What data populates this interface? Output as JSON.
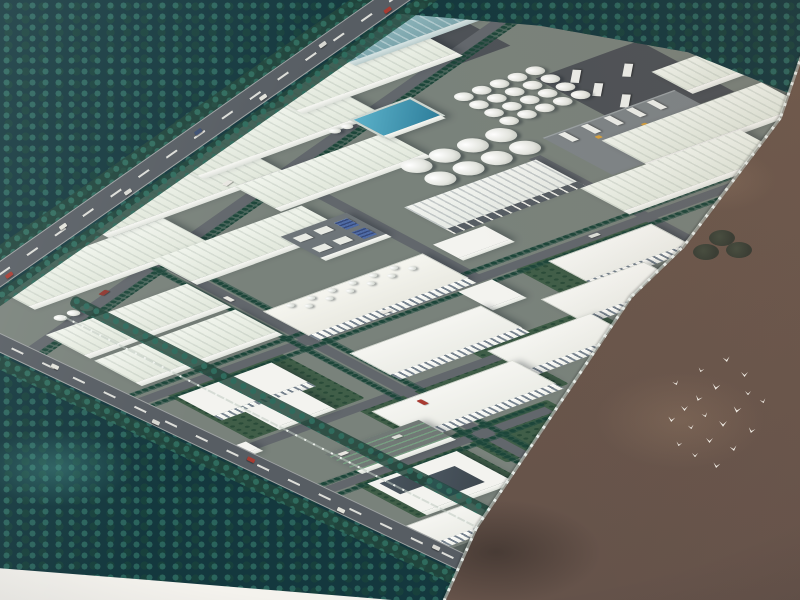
{
  "scene": {
    "type": "aerial-architectural-rendering-photo",
    "subject": "industrial-park-masterplan-birdseye",
    "palette": {
      "ground": "#79827b",
      "road": "#62676c",
      "hwy": "#575d63",
      "roof": "#f3f3ef",
      "lawn": "#405e48",
      "forest": "#14383e",
      "field": "#6f5a4d",
      "pool_blue": "#2e7e9b",
      "teal_roof": "#7fa9b0",
      "bird": "#f6f3ec",
      "wall": "#d4dad6"
    },
    "site": {
      "bases": [
        {
          "x": -40,
          "y": -270,
          "w": 820,
          "h": 625
        },
        {
          "x": -40,
          "y": 355,
          "w": 235,
          "h": 160
        },
        {
          "x": 185,
          "y": 340,
          "w": 240,
          "h": 75
        }
      ],
      "lawns": [
        {
          "x": 15,
          "y": 148,
          "w": 122,
          "h": 112
        },
        {
          "x": 28,
          "y": 366,
          "w": 112,
          "h": 90
        },
        {
          "x": 118,
          "y": 272,
          "w": 165,
          "h": 72
        },
        {
          "x": 258,
          "y": 248,
          "w": 128,
          "h": 62
        },
        {
          "x": 150,
          "y": 355,
          "w": 100,
          "h": 68
        },
        {
          "x": 385,
          "y": 155,
          "w": 150,
          "h": 60
        }
      ],
      "pads": [
        {
          "x": 567,
          "y": -216,
          "w": 80,
          "h": 55
        }
      ],
      "roads": [
        {
          "x": -90,
          "y": -101,
          "w": 870,
          "h": 12,
          "rot": -18
        },
        {
          "x": 164,
          "y": -45,
          "w": 12,
          "h": 560
        },
        {
          "x": 524,
          "y": 8,
          "w": 12,
          "h": 335
        },
        {
          "x": -10,
          "y": 144,
          "w": 650,
          "h": 12
        },
        {
          "x": -10,
          "y": 264,
          "w": 280,
          "h": 12
        },
        {
          "x": -15,
          "y": 364,
          "w": 255,
          "h": 12
        },
        {
          "x": 344,
          "y": -48,
          "w": 12,
          "h": 198
        }
      ],
      "groves": [
        {
          "x": -85,
          "y": -89,
          "w": 860,
          "h": 9,
          "rot": -18
        },
        {
          "x": -10,
          "y": 133,
          "w": 640,
          "h": 7
        },
        {
          "x": -10,
          "y": 158,
          "w": 640,
          "h": 7
        },
        {
          "x": 154,
          "y": -50,
          "w": 8,
          "h": 545
        },
        {
          "x": 178,
          "y": -50,
          "w": 8,
          "h": 545
        },
        {
          "x": -15,
          "y": 356,
          "w": 258,
          "h": 7
        },
        {
          "x": -15,
          "y": 378,
          "w": 258,
          "h": 7
        }
      ],
      "buildings": [
        {
          "kind": "wh",
          "name": "warehouse",
          "x": 33,
          "y": -96,
          "w": 190,
          "h": 55
        },
        {
          "kind": "wh",
          "name": "warehouse",
          "x": 165,
          "y": -159,
          "w": 190,
          "h": 55
        },
        {
          "kind": "wh",
          "name": "warehouse",
          "x": 295,
          "y": -192,
          "w": 190,
          "h": 54
        },
        {
          "kind": "wh",
          "name": "warehouse",
          "x": 435,
          "y": -229,
          "w": 170,
          "h": 50
        },
        {
          "kind": "whTeal",
          "name": "teal-roof-workshop",
          "x": 525,
          "y": -265,
          "w": 150,
          "h": 45
        },
        {
          "kind": "wh",
          "name": "warehouse",
          "x": 705,
          "y": -52,
          "w": 130,
          "h": 44
        },
        {
          "kind": "wh",
          "name": "warehouse",
          "x": 10,
          "y": 8,
          "w": 150,
          "h": 48
        },
        {
          "kind": "wh",
          "name": "warehouse",
          "x": 165,
          "y": -43,
          "w": 160,
          "h": 50
        },
        {
          "kind": "wh",
          "name": "warehouse",
          "x": 305,
          "y": -103,
          "w": 160,
          "h": 50
        },
        {
          "kind": "wh",
          "name": "warehouse",
          "x": 10,
          "y": 69,
          "w": 150,
          "h": 52
        },
        {
          "kind": "wh",
          "name": "warehouse",
          "x": 592,
          "y": 19,
          "w": 170,
          "h": 54
        },
        {
          "kind": "wh",
          "name": "warehouse",
          "x": 522,
          "y": 75,
          "w": 170,
          "h": 54
        },
        {
          "kind": "canopy",
          "name": "open-canopy-shed",
          "x": 388,
          "y": 12,
          "w": 140,
          "h": 52
        },
        {
          "kind": "plant",
          "name": "boiler-house",
          "x": 175,
          "y": 86,
          "w": 170,
          "h": 58
        },
        {
          "kind": "fl1",
          "name": "annex-building",
          "x": 322,
          "y": 158,
          "w": 36,
          "h": 38
        },
        {
          "kind": "fl3",
          "name": "workshop-building",
          "x": 415,
          "y": 161,
          "w": 110,
          "h": 48
        },
        {
          "kind": "fl3",
          "name": "workshop-building",
          "x": 365,
          "y": 211,
          "w": 110,
          "h": 48
        },
        {
          "kind": "fl3",
          "name": "workshop-building",
          "x": 270,
          "y": 256,
          "w": 110,
          "h": 48
        },
        {
          "kind": "fl3",
          "name": "workshop-building",
          "x": 180,
          "y": 189,
          "w": 140,
          "h": 52
        },
        {
          "kind": "fl3",
          "name": "workshop-building",
          "x": 125,
          "y": 282,
          "w": 150,
          "h": 55
        },
        {
          "kind": "fl2",
          "name": "lab-building",
          "x": 20,
          "y": 162,
          "w": 100,
          "h": 46
        },
        {
          "kind": "fl1",
          "name": "flat-storage",
          "x": 45,
          "y": 215,
          "w": 60,
          "h": 40
        },
        {
          "kind": "fl3",
          "name": "office-building",
          "x": 0,
          "y": 460,
          "w": 80,
          "h": 40
        },
        {
          "kind": "fl1",
          "name": "small-building",
          "x": 362,
          "y": 79,
          "w": 55,
          "h": 32
        },
        {
          "kind": "admin",
          "name": "admin-building",
          "x": 37,
          "y": 381,
          "w": 95,
          "h": 68
        },
        {
          "kind": "parking",
          "name": "parking-lot",
          "x": 45,
          "y": 318,
          "w": 100,
          "h": 40
        },
        {
          "kind": "equip",
          "name": "equipment-yard",
          "x": 275,
          "y": -10,
          "w": 70,
          "h": 50
        },
        {
          "kind": "pool",
          "name": "treatment-pool",
          "x": 457,
          "y": -140,
          "w": 66,
          "h": 44
        },
        {
          "kind": "fl1",
          "name": "gatehouse",
          "x": -10,
          "y": 260,
          "w": 20,
          "h": 16
        }
      ],
      "tank_groups": [
        {
          "name": "tank-farm-small",
          "x": 549,
          "y": -121,
          "cols": 5,
          "rows": 4,
          "d": 16,
          "gap": 3
        },
        {
          "name": "tank-farm-large",
          "x": 432,
          "y": -53,
          "cols": 4,
          "rows": 2,
          "d": 26,
          "gap": 4
        },
        {
          "name": "silo-row",
          "x": 34,
          "y": -14,
          "cols": 3,
          "rows": 1,
          "d": 11,
          "gap": 3
        },
        {
          "name": "pool-silos",
          "x": 430,
          "y": -136,
          "cols": 2,
          "rows": 1,
          "d": 10,
          "gap": 3
        }
      ],
      "chimneys": {
        "d": 7,
        "row1_v": 88,
        "row2_v": 98,
        "row1_u": [
          196,
          218,
          240,
          262,
          284,
          306
        ],
        "row2_u": [
          207,
          229,
          251,
          273,
          295,
          317
        ]
      },
      "truck_yard": {
        "x": 624,
        "y": -102,
        "w": 110,
        "h": 120,
        "truck_w": 24,
        "truck_h": 7,
        "truck_rot": -45,
        "trucks": [
          [
            640,
            -88
          ],
          [
            638,
            -58
          ],
          [
            642,
            -28
          ],
          [
            646,
            0
          ],
          [
            680,
            -70
          ]
        ]
      },
      "loading_dock": {
        "x": 558,
        "y": -15,
        "w": 140,
        "h": 88,
        "truck_w": 7,
        "truck_h": 18,
        "trucks": [
          [
            572,
            -12
          ],
          [
            596,
            -12
          ],
          [
            620,
            -12
          ],
          [
            644,
            -12
          ],
          [
            666,
            -12
          ]
        ],
        "forklifts": [
          [
            592,
            10
          ],
          [
            636,
            16
          ]
        ]
      },
      "cars": [
        {
          "x": 166,
          "y": 46,
          "w": 5,
          "h": 10,
          "c": "#e9e7e1"
        },
        {
          "x": 166,
          "y": 290,
          "w": 5,
          "h": 10,
          "c": "#a83a31"
        },
        {
          "x": 248,
          "y": 146,
          "w": 10,
          "h": 5,
          "c": "#e9e7e1"
        },
        {
          "x": 470,
          "y": 146,
          "w": 10,
          "h": 5,
          "c": "#dcded8"
        },
        {
          "x": 92,
          "y": -24,
          "w": 10,
          "h": 5,
          "c": "#8f3730",
          "rot": -18
        },
        {
          "x": 300,
          "y": -115,
          "w": 10,
          "h": 5,
          "c": "#e9e7e1",
          "rot": -18
        }
      ]
    },
    "overlays": {
      "highway": {
        "cx": 186,
        "cy": 144,
        "len": 660,
        "w": 22,
        "rot": -35,
        "treelines": [
          [
            176,
            129
          ],
          [
            197,
            160
          ]
        ],
        "cars": [
          [
            8,
            -5,
            "#d8d8d2"
          ],
          [
            16,
            4,
            "#a63c33"
          ],
          [
            27,
            -5,
            "#e2e2da"
          ],
          [
            38,
            4,
            "#d8d8d2"
          ],
          [
            52,
            -5,
            "#3c4f72"
          ],
          [
            63,
            4,
            "#e2e2da"
          ],
          [
            75,
            -5,
            "#d8d8d2"
          ],
          [
            86,
            4,
            "#a63c33"
          ]
        ]
      },
      "frontage": {
        "cx": 270,
        "cy": 471,
        "len": 640,
        "w": 18,
        "rot": 25.4,
        "treelines": [
          [
            261,
            486
          ]
        ],
        "cars": [
          [
            12,
            -4,
            "#e2e2da"
          ],
          [
            30,
            3,
            "#d8d8d2"
          ],
          [
            46,
            -4,
            "#a63c33"
          ],
          [
            62,
            3,
            "#e2e2da"
          ],
          [
            78,
            -4,
            "#d8d8d2"
          ]
        ]
      },
      "front_grove": {
        "cx": 285,
        "cy": 409,
        "len": 480,
        "h": 12,
        "rot": 27
      },
      "front_wall": {
        "cx": 282,
        "cy": 428,
        "len": 490,
        "rot": 27
      },
      "wall_segments": [
        [
          795,
          74,
          93,
          108.8
        ],
        [
          731,
          183,
          163,
          127
        ],
        [
          656,
          273,
          72,
          136
        ],
        [
          553,
          413,
          277,
          123.8
        ],
        [
          460,
          564,
          79,
          114
        ]
      ],
      "field_trees": [
        [
          722,
          238
        ],
        [
          739,
          250
        ],
        [
          706,
          252
        ]
      ],
      "birds": [
        [
          723,
          357,
          7,
          -10
        ],
        [
          698,
          368,
          6,
          15
        ],
        [
          741,
          372,
          7,
          0
        ],
        [
          673,
          381,
          6,
          -20
        ],
        [
          712,
          384,
          8,
          10
        ],
        [
          745,
          391,
          6,
          0
        ],
        [
          695,
          396,
          7,
          20
        ],
        [
          760,
          399,
          6,
          -15
        ],
        [
          681,
          406,
          7,
          0
        ],
        [
          733,
          407,
          8,
          12
        ],
        [
          702,
          413,
          6,
          -18
        ],
        [
          668,
          417,
          7,
          8
        ],
        [
          719,
          421,
          8,
          0
        ],
        [
          688,
          425,
          6,
          -10
        ],
        [
          748,
          428,
          7,
          15
        ],
        [
          706,
          438,
          7,
          0
        ],
        [
          676,
          442,
          6,
          12
        ],
        [
          730,
          446,
          7,
          -12
        ],
        [
          692,
          453,
          6,
          0
        ],
        [
          713,
          463,
          7,
          10
        ]
      ]
    }
  }
}
